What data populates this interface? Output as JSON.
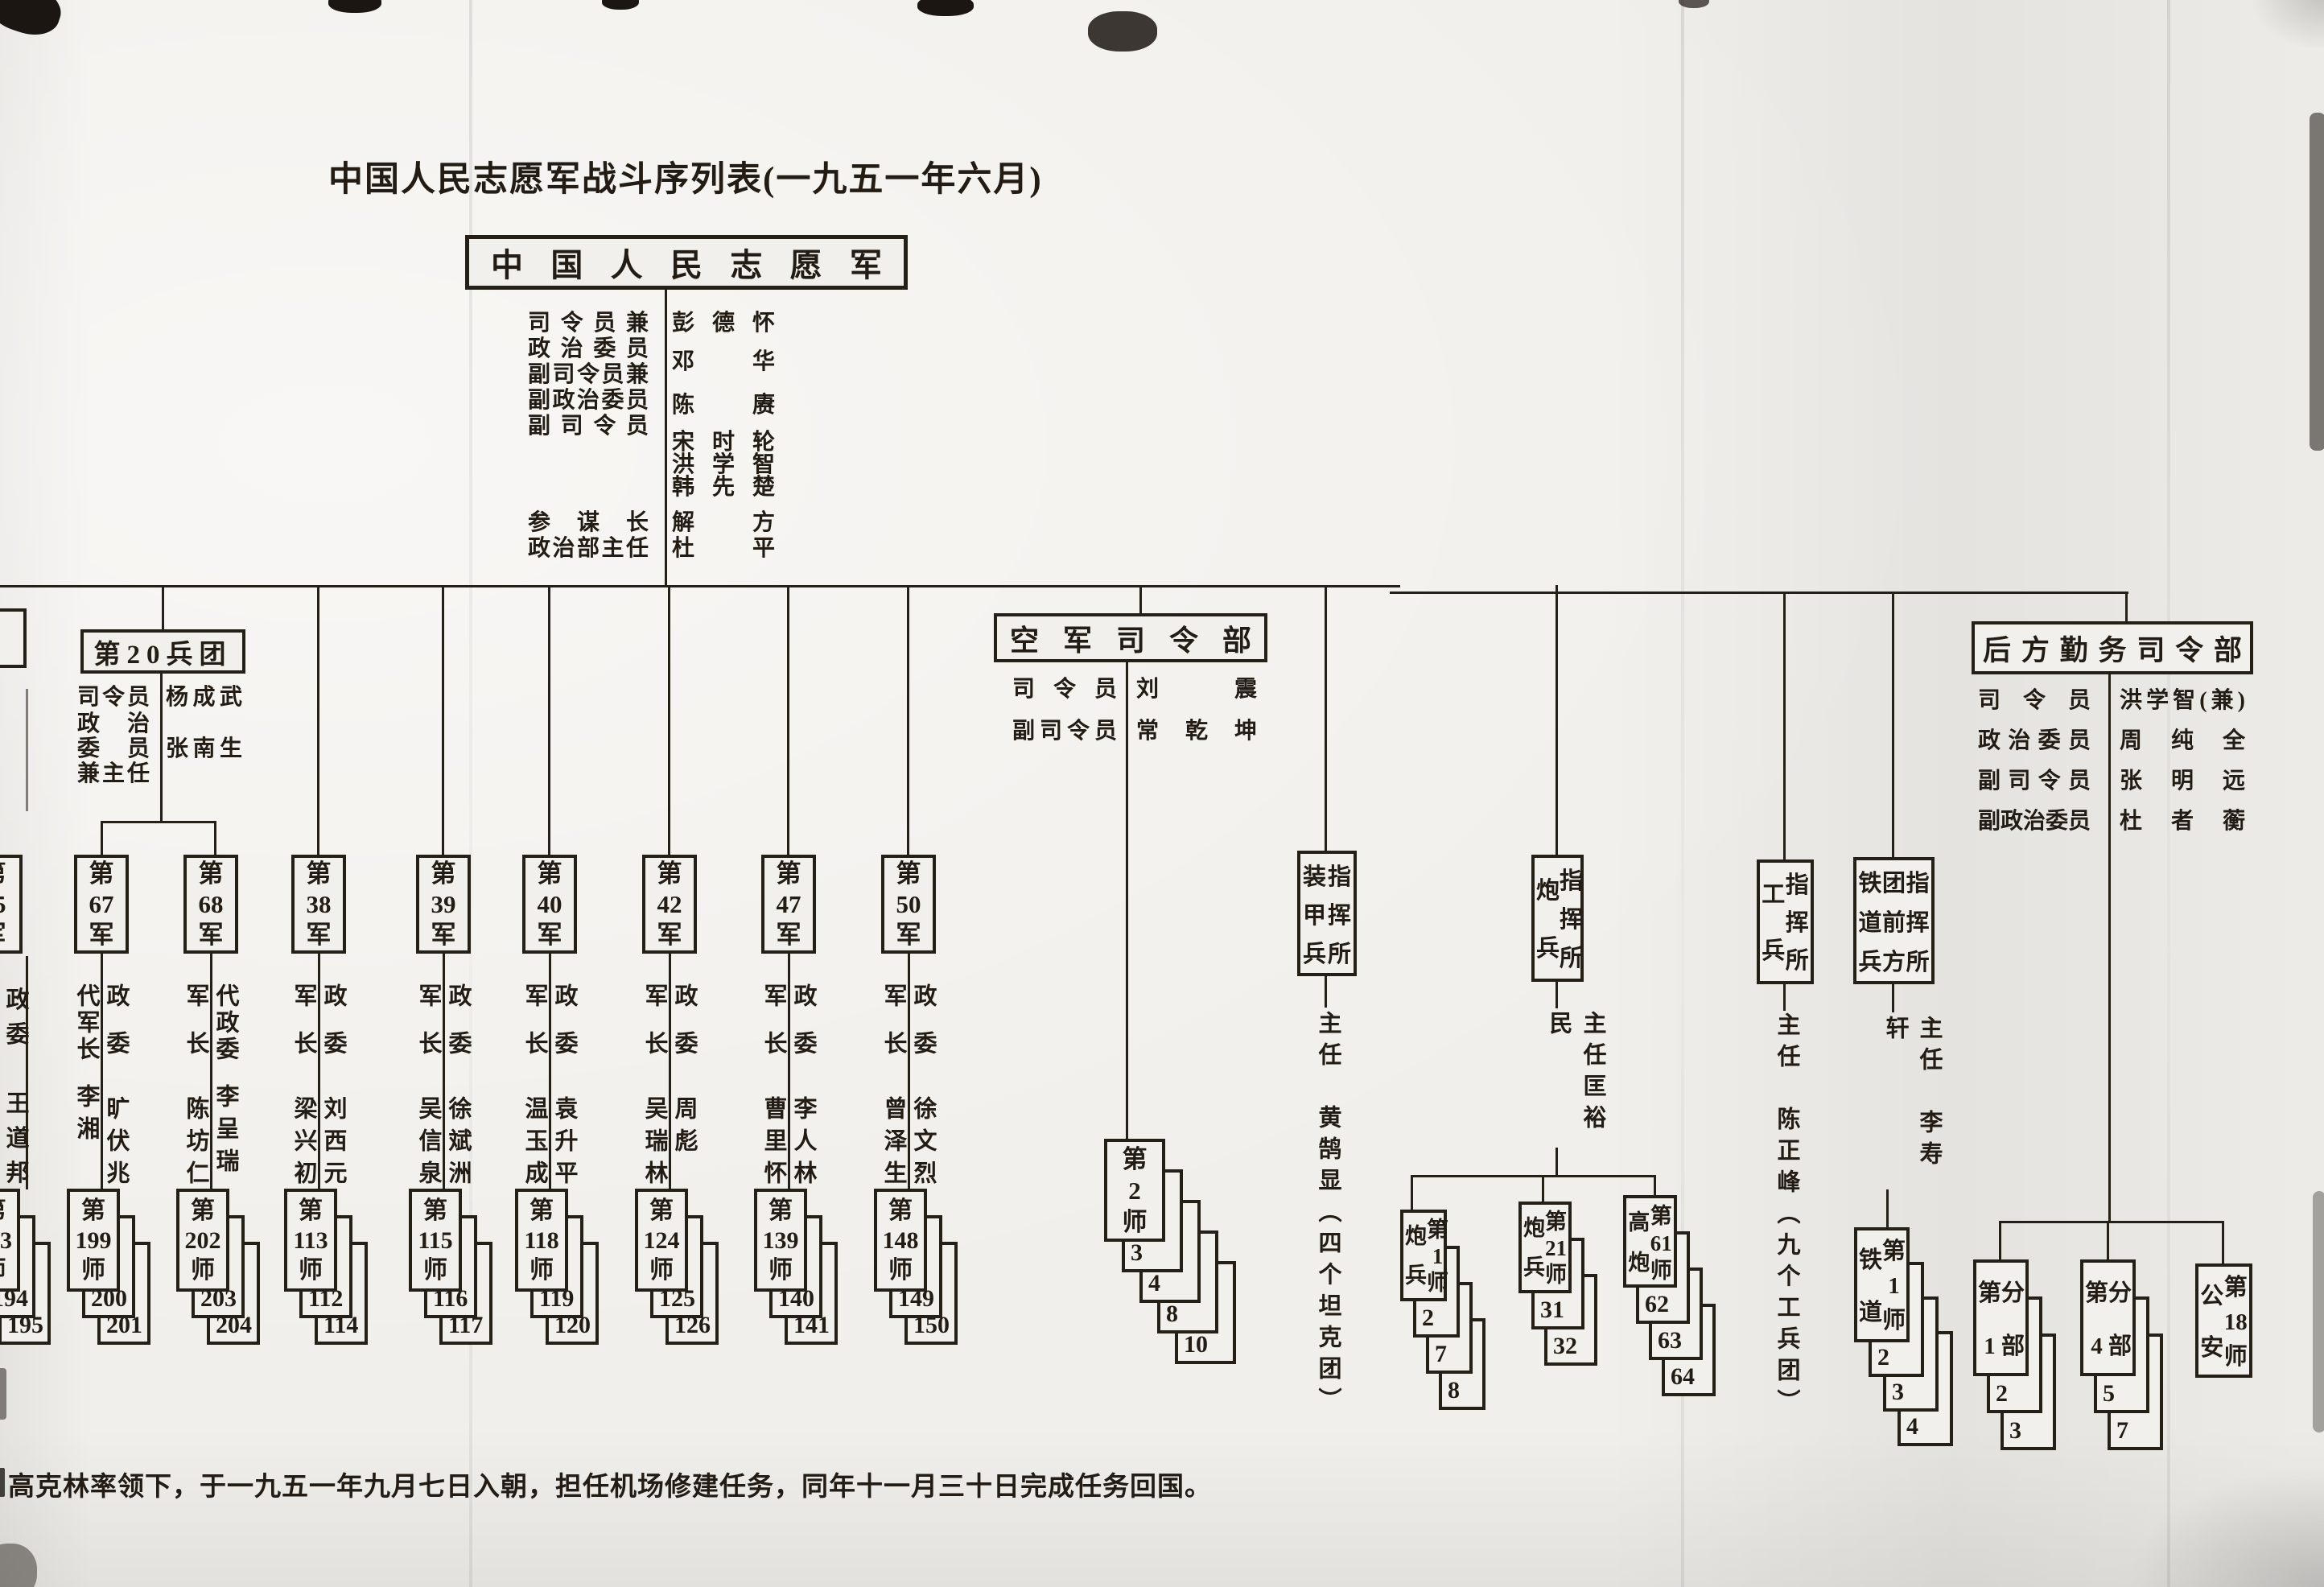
{
  "page": {
    "title": "中国人民志愿军战斗序列表(一九五一年六月)",
    "footnote": "高克林率领下，于一九五一年九月七日入朝，担任机场修建任务，同年十一月三十日完成任务回国。",
    "paper_color": "#f1efeb",
    "ink_color": "#241f17"
  },
  "hq": {
    "name": "中国人民志愿军",
    "p1": "司令员兼",
    "p2": "政治委员",
    "p3": "副司令员兼",
    "p4": "副政治委员",
    "p5": "副司令员",
    "p6": "参谋长",
    "p7": "政治部主任",
    "n1": "彭德怀",
    "n2": "邓华",
    "n3": "陈赓",
    "n4": "宋时轮",
    "n5": "洪学智",
    "n6": "韩先楚",
    "n7": "解方",
    "n8": "杜平"
  },
  "corps20": {
    "title": "第20兵团",
    "p1": "司令员",
    "p2": "政治",
    "p3": "委员",
    "p4": "兼主任",
    "n1": "杨成武",
    "n2": "张南生"
  },
  "fragments": {
    "corps_box": "",
    "army65_num": "第\n65\n军",
    "army65_col": "政\n委\n\n王\n道\n邦",
    "division193": "第\n193\n师",
    "reg193_1": "194",
    "reg193_2": "195"
  },
  "armies": [
    {
      "num": "第\n67\n军",
      "cmd_title": "代军长",
      "cmd_name": "李湘",
      "pc_title": "政委",
      "pc_name": "旷伏兆",
      "division": "第\n199\n师",
      "regiments": [
        "200",
        "201"
      ]
    },
    {
      "num": "第\n68\n军",
      "cmd_title": "军长",
      "cmd_name": "陈坊仁",
      "pc_title": "代政委",
      "pc_name": "李呈瑞",
      "division": "第\n202\n师",
      "regiments": [
        "203",
        "204"
      ]
    },
    {
      "num": "第\n38\n军",
      "cmd_title": "军长",
      "cmd_name": "梁兴初",
      "pc_title": "政委",
      "pc_name": "刘西元",
      "division": "第\n113\n师",
      "regiments": [
        "112",
        "114"
      ]
    },
    {
      "num": "第\n39\n军",
      "cmd_title": "军长",
      "cmd_name": "吴信泉",
      "pc_title": "政委",
      "pc_name": "徐斌洲",
      "division": "第\n115\n师",
      "regiments": [
        "116",
        "117"
      ]
    },
    {
      "num": "第\n40\n军",
      "cmd_title": "军长",
      "cmd_name": "温玉成",
      "pc_title": "政委",
      "pc_name": "袁升平",
      "division": "第\n118\n师",
      "regiments": [
        "119",
        "120"
      ]
    },
    {
      "num": "第\n42\n军",
      "cmd_title": "军长",
      "cmd_name": "吴瑞林",
      "pc_title": "政委",
      "pc_name": "周彪",
      "division": "第\n124\n师",
      "regiments": [
        "125",
        "126"
      ]
    },
    {
      "num": "第\n47\n军",
      "cmd_title": "军长",
      "cmd_name": "曹里怀",
      "pc_title": "政委",
      "pc_name": "李人林",
      "division": "第\n139\n师",
      "regiments": [
        "140",
        "141"
      ]
    },
    {
      "num": "第\n50\n军",
      "cmd_title": "军长",
      "cmd_name": "曾泽生",
      "pc_title": "政委",
      "pc_name": "徐文烈",
      "division": "第\n148\n师",
      "regiments": [
        "149",
        "150"
      ]
    }
  ],
  "air": {
    "title": "空军司令部",
    "l1": "司令员",
    "n1": "刘震",
    "l2": "副司令员",
    "n2": "常乾坤",
    "division": "第\n2\n师",
    "regiments": [
      "3",
      "4",
      "8",
      "10"
    ]
  },
  "armor": {
    "c1": "装\n甲\n兵",
    "c2": "指\n挥\n所",
    "director": "主任　黄鹄显（四个坦克团）"
  },
  "artillery": {
    "c1": "炮\n兵",
    "c2": "指\n挥\n所",
    "director": "主任匡裕民",
    "divisions": [
      {
        "c1": "炮\n兵",
        "c2": "第\n1\n师",
        "regs": [
          "2",
          "7",
          "8"
        ]
      },
      {
        "c1": "炮\n兵",
        "c2": "第\n21\n师",
        "regs": [
          "31",
          "32"
        ]
      },
      {
        "c1": "高\n炮",
        "c2": "第\n61\n师",
        "regs": [
          "62",
          "63",
          "64"
        ]
      }
    ]
  },
  "engineers": {
    "c1": "工\n兵",
    "c2": "指\n挥\n所",
    "director": "主任　陈正峰（九个工兵团）"
  },
  "railway": {
    "c1": "铁\n道\n兵",
    "c2": "团\n前\n方",
    "c3": "指\n挥\n所",
    "director": "主任　李寿轩",
    "division": {
      "c1": "铁\n道",
      "c2": "第\n1\n师",
      "regs": [
        "2",
        "3",
        "4"
      ]
    }
  },
  "logistics": {
    "title": "后方勤务司令部",
    "l1": "司令员",
    "n1": "洪学智(兼)",
    "l2": "政治委员",
    "n2": "周纯全",
    "l3": "副司令员",
    "n3": "张明远",
    "l4": "副政治委员",
    "n4": "杜者蘅",
    "units": [
      {
        "c1": "第\n1",
        "c2": "分\n部",
        "regs": [
          "2",
          "3"
        ]
      },
      {
        "c1": "第\n4",
        "c2": "分\n部",
        "regs": [
          "5",
          "7"
        ]
      },
      {
        "c1": "公\n安",
        "c2": "第\n18\n师",
        "regs": []
      }
    ]
  }
}
